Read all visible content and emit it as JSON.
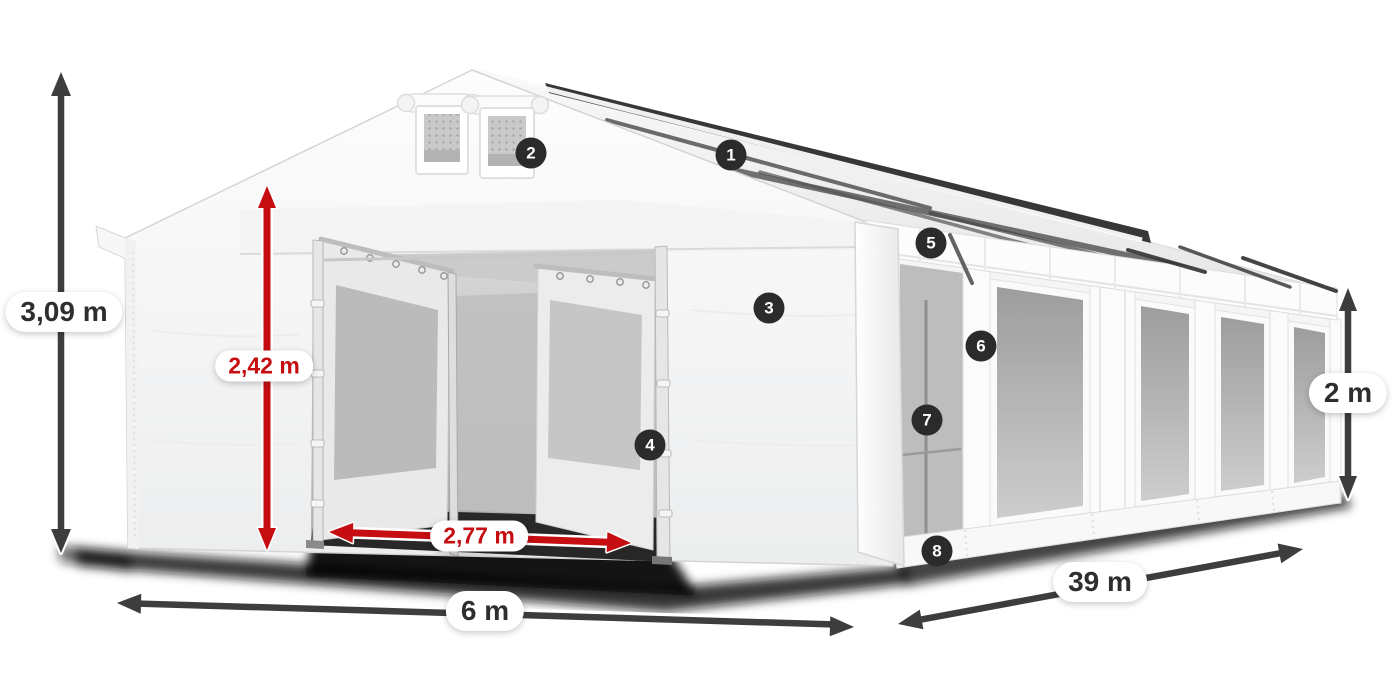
{
  "diagram": {
    "dimensions": {
      "total_height": "3,09 m",
      "entrance_height": "2,42 m",
      "entrance_width": "2,77 m",
      "tent_width": "6 m",
      "tent_length": "39 m",
      "side_wall_height": "2 m"
    },
    "callouts": [
      "1",
      "2",
      "3",
      "4",
      "5",
      "6",
      "7",
      "8"
    ],
    "colors": {
      "dimension_arrow": "#3d3d3d",
      "dimension_accent_red": "#c50d12",
      "badge_background": "#2b2b2b",
      "badge_text": "#ffffff",
      "label_text": "#2e2e2e",
      "label_background": "#ffffff"
    }
  }
}
